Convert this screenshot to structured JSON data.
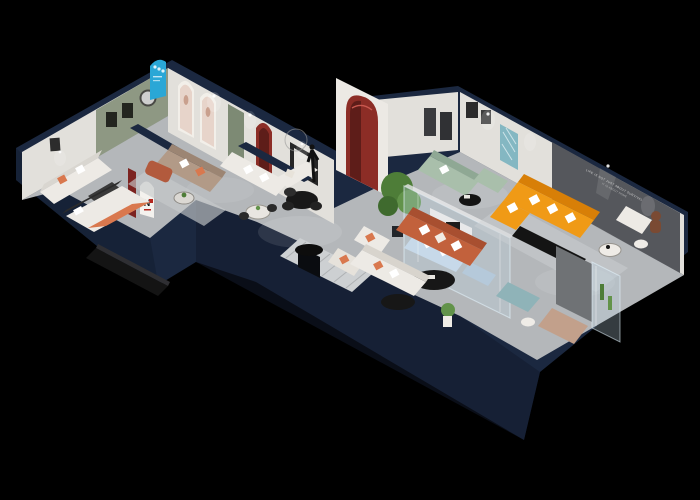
{
  "meta": {
    "description": "3D isometric cutaway render of a furniture showroom floor plan on a black background",
    "background": "#000000"
  },
  "scene": {
    "wall_slogan_line1": "LIFE IS NOT JUST ABOUT SURVIVAL",
    "wall_slogan_line2": "IT IS ABOUT HOME",
    "arch_logo": "N"
  },
  "palette": {
    "navy": "#1b2840",
    "navy-dark": "#121a2c",
    "navy-light": "#2a3b5a",
    "floor": "#b4b7ba",
    "floor-light": "#cdd0d2",
    "wall-white": "#e2e0db",
    "wall-shade": "#c2bfb9",
    "green-wall": "#8e9883",
    "green-door": "#7d8a74",
    "dark-wall": "#55575c",
    "red-arch": "#8c2d26",
    "red-deep": "#5e1d19",
    "maroon": "#7c2320",
    "blue-poster": "#2aa7d6",
    "teal-art": "#84b7c2",
    "orange": "#f09a16",
    "orange-deep": "#d87f07",
    "terracotta": "#c2613c",
    "rust": "#d9784e",
    "sage": "#a9bfab",
    "taupe": "#b29a87",
    "copper": "#b25a3d",
    "light-blue": "#c7d9e9",
    "teal-ottoman": "#8fb3b8",
    "tan": "#c2a08b",
    "bear": "#7a4a33",
    "plant": "#4e7d38",
    "plant-light": "#62934a",
    "black-furn": "#141414",
    "white-furn": "#edeae5",
    "rug": "#c6c9cb",
    "glass": "rgba(190,215,230,0.28)",
    "glass-edge": "rgba(230,245,255,0.55)"
  }
}
